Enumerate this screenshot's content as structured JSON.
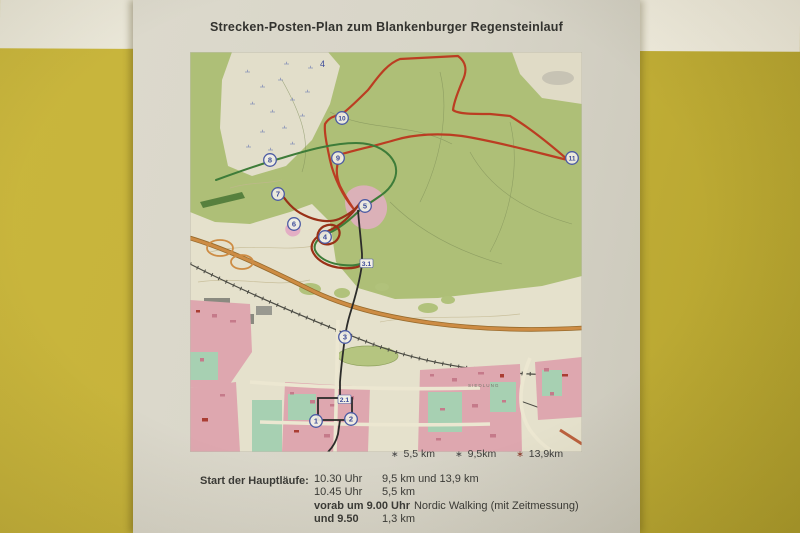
{
  "scene": {
    "wall_color": "#c6b239",
    "stripe_color": "#ebe8d9",
    "paper_color": "#d8d5c8"
  },
  "poster": {
    "title": "Strecken-Posten-Plan zum Blankenburger Regensteinlauf",
    "map": {
      "grid_label": "4",
      "area_label": "SIEDLUNG",
      "route_colors": {
        "red": "#c23a1d",
        "brown": "#9e2e12",
        "green": "#3a7d35",
        "black": "#2a2a28"
      },
      "marker_color": "#4a5aa8",
      "marker_text_color": "#3a4a9e",
      "checkpoints": [
        {
          "label": "1",
          "x": 126,
          "y": 369
        },
        {
          "label": "2",
          "x": 161,
          "y": 367
        },
        {
          "label": "3",
          "x": 155,
          "y": 285
        },
        {
          "label": "4",
          "x": 135,
          "y": 185
        },
        {
          "label": "5",
          "x": 175,
          "y": 154
        },
        {
          "label": "6",
          "x": 104,
          "y": 172
        },
        {
          "label": "7",
          "x": 88,
          "y": 142
        },
        {
          "label": "8",
          "x": 80,
          "y": 108
        },
        {
          "label": "9",
          "x": 148,
          "y": 106
        },
        {
          "label": "10",
          "x": 152,
          "y": 66
        },
        {
          "label": "11",
          "x": 382,
          "y": 106
        }
      ],
      "waypoints": [
        {
          "label": "3.1",
          "x": 172,
          "y": 212
        },
        {
          "label": "2.1",
          "x": 150,
          "y": 348
        }
      ]
    },
    "legend": [
      {
        "label": "5,5 km",
        "marker": "∗",
        "marker_color": "#4a4a4a"
      },
      {
        "label": "9,5km",
        "marker": "∗",
        "marker_color": "#4a4a4a"
      },
      {
        "label": "13,9km",
        "marker": "∗",
        "marker_color": "#8a3a2a"
      }
    ],
    "schedule": {
      "heading": "Start der Hauptläufe:",
      "rows": [
        {
          "time": "10.30 Uhr",
          "detail": "9,5 km und 13,9  km",
          "bold_time": false
        },
        {
          "time": "10.45 Uhr",
          "detail": "5,5 km",
          "bold_time": false
        },
        {
          "time": "vorab um 9.00 Uhr",
          "detail": "Nordic Walking (mit Zeitmessung)",
          "bold_time": true
        },
        {
          "time": "und 9.50",
          "detail": "1,3 km",
          "bold_time": true
        }
      ]
    }
  }
}
